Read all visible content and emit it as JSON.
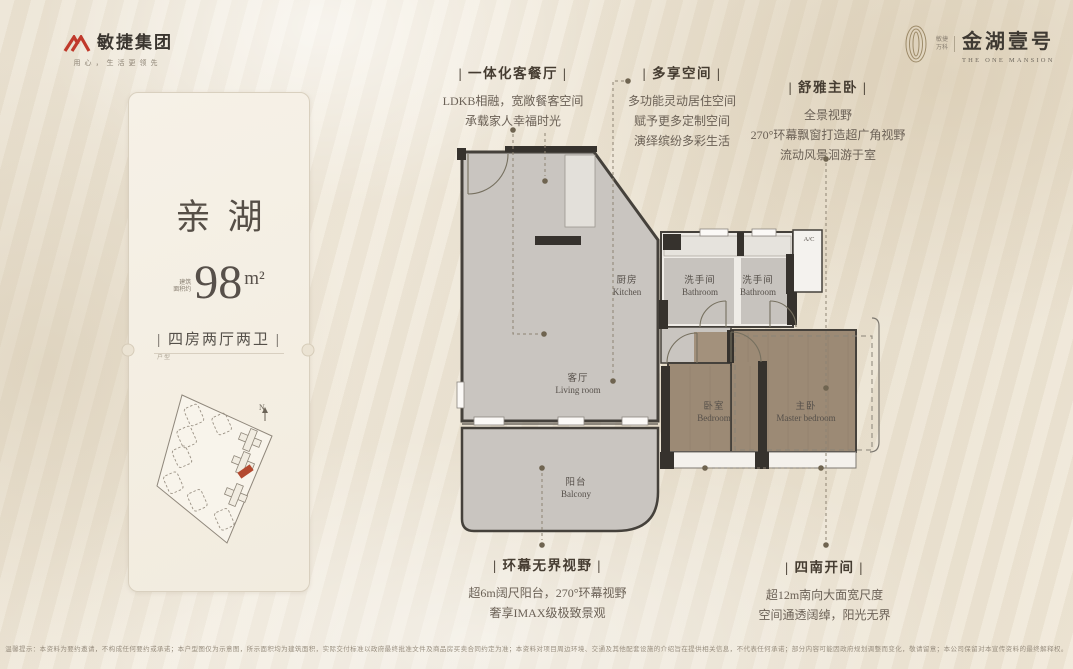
{
  "colors": {
    "page_bg": "#ebe3d3",
    "accent_red": "#b3492f",
    "wall": "#36322d",
    "floor_gray": "#c9c5c0",
    "wood": "#9c8a75",
    "title_text": "#453c31",
    "body_text": "#6b6156"
  },
  "brand_left": {
    "name": "敏捷集团",
    "slogan": "用心，生活更领先"
  },
  "brand_right": {
    "tag_line1": "敏捷",
    "tag_line2": "万科",
    "name": "金湖壹号",
    "subtitle": "THE ONE MANSION"
  },
  "card": {
    "title": "亲湖",
    "area_label_1": "建筑",
    "area_label_2": "面积约",
    "area_value": "98",
    "area_unit": "m²",
    "layout": "| 四房两厅两卫 |",
    "layout_note": "户型",
    "north": "N"
  },
  "annotations": {
    "top": [
      {
        "title": "| 一体化客餐厅 |",
        "lines": [
          "LDKB相融，宽敞餐客空间",
          "承载家人幸福时光"
        ]
      },
      {
        "title": "| 多享空间 |",
        "lines": [
          "多功能灵动居住空间",
          "赋予更多定制空间",
          "演绎缤纷多彩生活"
        ]
      },
      {
        "title": "| 舒雅主卧 |",
        "lines": [
          "全景视野",
          "270°环幕飘窗打造超广角视野",
          "流动风景洄游于室"
        ]
      }
    ],
    "bottom": [
      {
        "title": "| 环幕无界视野 |",
        "lines": [
          "超6m阔尺阳台，270°环幕视野",
          "奢享IMAX级极致景观"
        ]
      },
      {
        "title": "| 四南开间 |",
        "lines": [
          "超12m南向大面宽尺度",
          "空间通透阔绰，阳光无界"
        ]
      }
    ]
  },
  "floorplan": {
    "rooms": {
      "kitchen": {
        "cn": "厨房",
        "en": "Kitchen"
      },
      "bath1": {
        "cn": "洗手间",
        "en": "Bathroom"
      },
      "bath2": {
        "cn": "洗手间",
        "en": "Bathroom"
      },
      "living": {
        "cn": "客厅",
        "en": "Living room"
      },
      "balcony": {
        "cn": "阳台",
        "en": "Balcony"
      },
      "bedroom": {
        "cn": "卧室",
        "en": "Bedroom"
      },
      "master": {
        "cn": "主卧",
        "en": "Master bedroom"
      },
      "ac": "A/C"
    }
  },
  "footer": {
    "disclaimer": "温馨提示：本资料为要约邀请，不构成任何要约或承诺；本户型图仅为示意图，所示面积均为建筑面积，实际交付标准以政府最终批准文件及商品房买卖合同约定为准；本资料对项目周边环境、交通及其他配套设施的介绍旨在提供相关信息，不代表任何承诺；部分内容可能因政府规划调整而变化，敬请留意；本公司保留对本宣传资料的最终解释权。"
  }
}
